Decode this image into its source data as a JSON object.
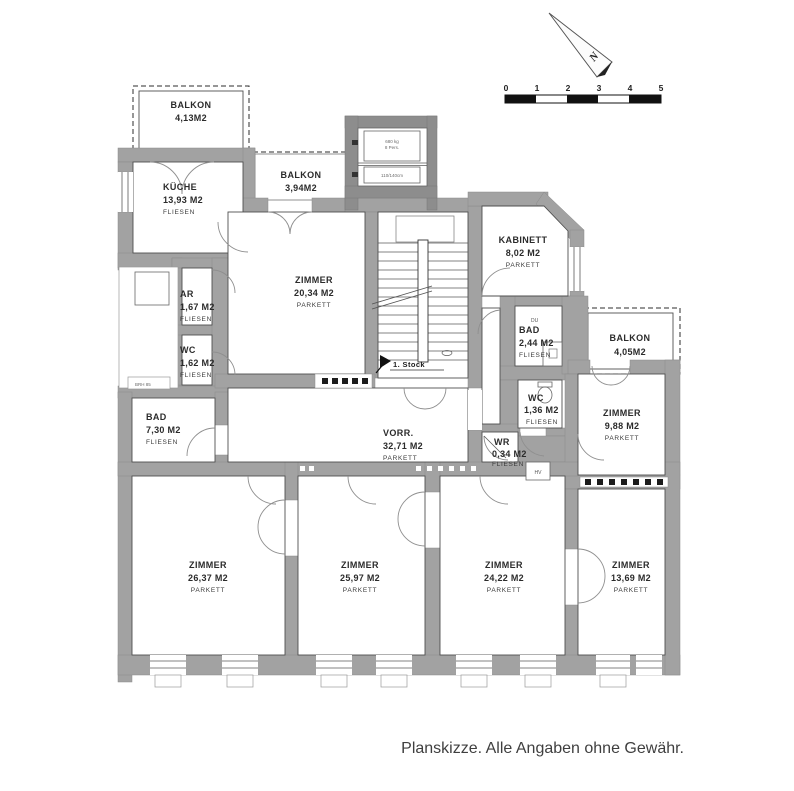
{
  "caption": "Planskizze. Alle Angaben ohne Gewähr.",
  "compass": {
    "label": "N"
  },
  "scale_bar": {
    "labels": [
      "0",
      "1",
      "2",
      "3",
      "4",
      "5"
    ]
  },
  "floor_marker": "1. Stock",
  "rooms": {
    "balkon_tl": {
      "name": "BALKON",
      "area": "4,13M2",
      "floor": ""
    },
    "kueche": {
      "name": "KÜCHE",
      "area": "13,93 M2",
      "floor": "FLIESEN"
    },
    "balkon_mid": {
      "name": "BALKON",
      "area": "3,94M2",
      "floor": ""
    },
    "zimmer_2034": {
      "name": "ZIMMER",
      "area": "20,34 M2",
      "floor": "PARKETT"
    },
    "kabinett": {
      "name": "KABINETT",
      "area": "8,02 M2",
      "floor": "PARKETT"
    },
    "ar": {
      "name": "AR",
      "area": "1,67 M2",
      "floor": "FLIESEN"
    },
    "wc_162": {
      "name": "WC",
      "area": "1,62 M2",
      "floor": "FLIESEN"
    },
    "bad_244": {
      "name": "BAD",
      "area": "2,44 M2",
      "floor": "FLIESEN"
    },
    "balkon_r": {
      "name": "BALKON",
      "area": "4,05M2",
      "floor": ""
    },
    "bad_730": {
      "name": "BAD",
      "area": "7,30 M2",
      "floor": "FLIESEN"
    },
    "vorr": {
      "name": "VORR.",
      "area": "32,71 M2",
      "floor": "PARKETT"
    },
    "wc_136": {
      "name": "WC",
      "area": "1,36 M2",
      "floor": "FLIESEN"
    },
    "wr": {
      "name": "WR",
      "area": "0,34 M2",
      "floor": "FLIESEN"
    },
    "zimmer_988": {
      "name": "ZIMMER",
      "area": "9,88 M2",
      "floor": "PARKETT"
    },
    "zimmer_2637": {
      "name": "ZIMMER",
      "area": "26,37 M2",
      "floor": "PARKETT"
    },
    "zimmer_2597": {
      "name": "ZIMMER",
      "area": "25,97 M2",
      "floor": "PARKETT"
    },
    "zimmer_2422": {
      "name": "ZIMMER",
      "area": "24,22 M2",
      "floor": "PARKETT"
    },
    "zimmer_1369": {
      "name": "ZIMMER",
      "area": "13,69 M2",
      "floor": "PARKETT"
    }
  },
  "annotations": {
    "du": "DU",
    "hv": "HV",
    "sill": "BRH 85",
    "lift_line1": "680 kg",
    "lift_line2": "8 Pers.",
    "lift_line3": "110/140cm"
  },
  "colors": {
    "wall": "#a2a2a2",
    "wall_dark": "#8d8d8d",
    "line": "#4f4f4f",
    "text": "#2b2b2b"
  }
}
